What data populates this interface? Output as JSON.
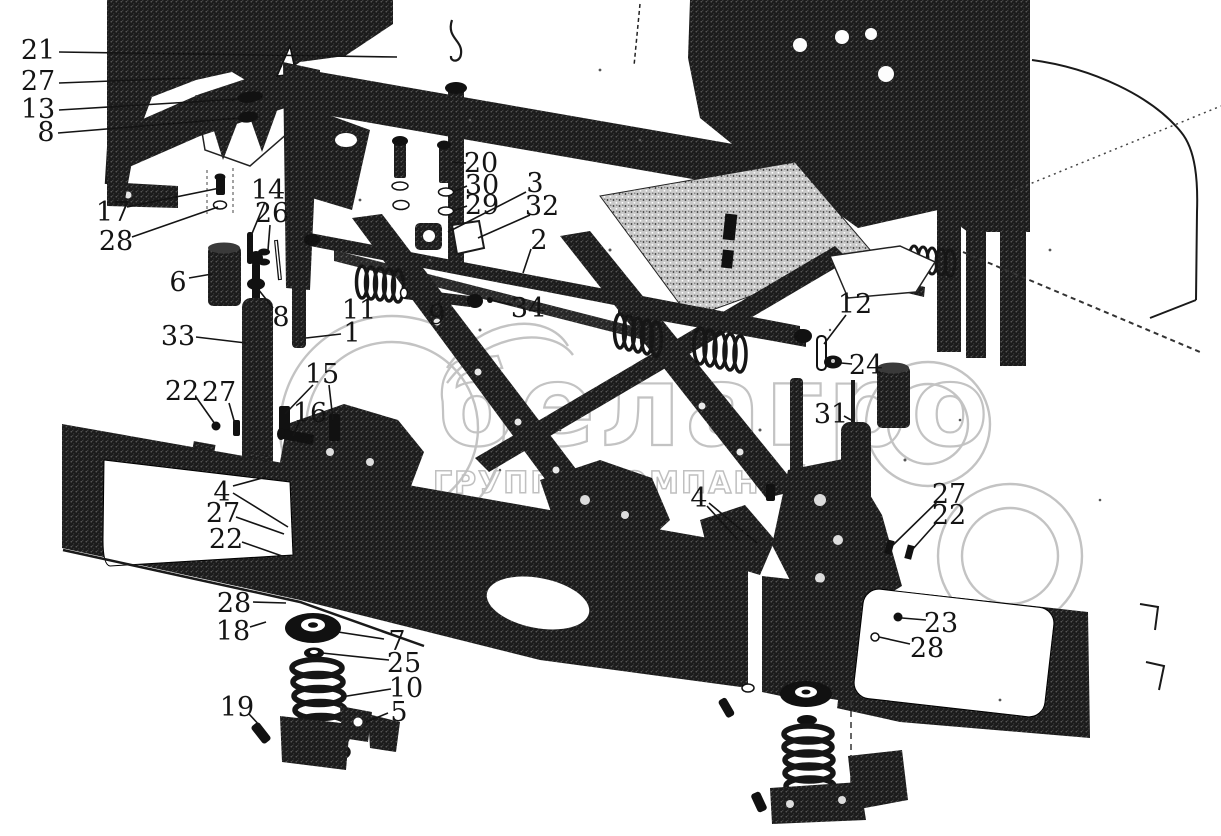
{
  "watermark": {
    "brand": "белагро",
    "subtitle": "ГРУППА КОМПАНИЙ",
    "color": "#c3c3c3"
  },
  "diagram": {
    "background": "#ffffff",
    "ink": "#141414",
    "callout_font_size": 27,
    "callouts": [
      {
        "label": "21",
        "x": 38,
        "y": 50,
        "leaders": [
          [
            59,
            52,
            397,
            57
          ]
        ]
      },
      {
        "label": "27",
        "x": 38,
        "y": 81,
        "leaders": [
          [
            59,
            83,
            190,
            78
          ]
        ]
      },
      {
        "label": "13",
        "x": 38,
        "y": 109,
        "leaders": [
          [
            59,
            110,
            240,
            99
          ]
        ]
      },
      {
        "label": "8",
        "x": 46,
        "y": 132,
        "leaders": [
          [
            58,
            133,
            240,
            118
          ]
        ]
      },
      {
        "label": "17",
        "x": 113,
        "y": 212,
        "leaders": [
          [
            127,
            207,
            220,
            188
          ]
        ]
      },
      {
        "label": "28",
        "x": 116,
        "y": 241,
        "leaders": [
          [
            132,
            237,
            218,
            207
          ]
        ]
      },
      {
        "label": "6",
        "x": 178,
        "y": 282,
        "leaders": [
          [
            189,
            278,
            212,
            274
          ]
        ]
      },
      {
        "label": "33",
        "x": 178,
        "y": 336,
        "leaders": [
          [
            196,
            337,
            246,
            343
          ]
        ]
      },
      {
        "label": "14",
        "x": 268,
        "y": 190,
        "leaders": [
          [
            265,
            202,
            251,
            236
          ]
        ]
      },
      {
        "label": "26",
        "x": 272,
        "y": 213,
        "leaders": [
          [
            270,
            225,
            268,
            250
          ]
        ]
      },
      {
        "label": "8",
        "x": 281,
        "y": 317,
        "leaders": [
          [
            273,
            308,
            258,
            289
          ]
        ]
      },
      {
        "label": "1",
        "x": 352,
        "y": 333,
        "leaders": [
          [
            341,
            334,
            306,
            338
          ]
        ]
      },
      {
        "label": "11",
        "x": 359,
        "y": 310,
        "leaders": [
          [
            362,
            299,
            368,
            293
          ]
        ]
      },
      {
        "label": "9",
        "x": 437,
        "y": 315,
        "leaders": [
          [
            439,
            304,
            441,
            298
          ]
        ]
      },
      {
        "label": "22",
        "x": 182,
        "y": 391,
        "leaders": [
          [
            196,
            397,
            215,
            424
          ]
        ]
      },
      {
        "label": "27",
        "x": 219,
        "y": 392,
        "leaders": [
          [
            229,
            403,
            235,
            424
          ]
        ]
      },
      {
        "label": "15",
        "x": 322,
        "y": 374,
        "leaders": [
          [
            313,
            385,
            285,
            414
          ],
          [
            329,
            385,
            333,
            420
          ]
        ]
      },
      {
        "label": "16",
        "x": 310,
        "y": 413,
        "leaders": [
          [
            300,
            420,
            293,
            436
          ]
        ]
      },
      {
        "label": "20",
        "x": 481,
        "y": 163,
        "leaders": [
          [
            466,
            163,
            452,
            162
          ]
        ]
      },
      {
        "label": "30",
        "x": 482,
        "y": 185,
        "leaders": [
          [
            467,
            186,
            453,
            192
          ]
        ]
      },
      {
        "label": "29",
        "x": 482,
        "y": 205,
        "leaders": [
          [
            467,
            206,
            453,
            211
          ]
        ]
      },
      {
        "label": "3",
        "x": 535,
        "y": 183,
        "leaders": [
          [
            526,
            192,
            448,
            232
          ]
        ]
      },
      {
        "label": "32",
        "x": 542,
        "y": 206,
        "leaders": [
          [
            530,
            215,
            478,
            238
          ]
        ]
      },
      {
        "label": "2",
        "x": 539,
        "y": 240,
        "leaders": [
          [
            531,
            249,
            523,
            273
          ]
        ]
      },
      {
        "label": "34",
        "x": 528,
        "y": 308,
        "leaders": [
          [
            513,
            305,
            491,
            300
          ]
        ]
      },
      {
        "label": "4",
        "x": 222,
        "y": 492,
        "leaders": [
          [
            233,
            486,
            266,
            477
          ],
          [
            233,
            493,
            288,
            527
          ]
        ]
      },
      {
        "label": "27",
        "x": 223,
        "y": 513,
        "leaders": [
          [
            236,
            517,
            284,
            534
          ]
        ]
      },
      {
        "label": "22",
        "x": 226,
        "y": 539,
        "leaders": [
          [
            242,
            542,
            282,
            556
          ]
        ]
      },
      {
        "label": "28",
        "x": 234,
        "y": 603,
        "leaders": [
          [
            253,
            602,
            286,
            603
          ]
        ]
      },
      {
        "label": "18",
        "x": 233,
        "y": 631,
        "leaders": [
          [
            250,
            627,
            266,
            622
          ]
        ]
      },
      {
        "label": "7",
        "x": 397,
        "y": 641,
        "leaders": [
          [
            384,
            639,
            338,
            632
          ]
        ]
      },
      {
        "label": "25",
        "x": 404,
        "y": 663,
        "leaders": [
          [
            389,
            660,
            322,
            653
          ]
        ]
      },
      {
        "label": "10",
        "x": 406,
        "y": 688,
        "leaders": [
          [
            391,
            689,
            341,
            697
          ]
        ]
      },
      {
        "label": "5",
        "x": 399,
        "y": 712,
        "leaders": [
          [
            388,
            713,
            366,
            722
          ]
        ]
      },
      {
        "label": "19",
        "x": 237,
        "y": 707,
        "leaders": [
          [
            249,
            714,
            262,
            728
          ]
        ]
      },
      {
        "label": "12",
        "x": 855,
        "y": 304,
        "leaders": [
          [
            846,
            315,
            824,
            344
          ]
        ]
      },
      {
        "label": "24",
        "x": 866,
        "y": 365,
        "leaders": [
          [
            852,
            364,
            841,
            363
          ]
        ]
      },
      {
        "label": "31",
        "x": 831,
        "y": 414,
        "leaders": [
          [
            844,
            416,
            851,
            420
          ]
        ]
      },
      {
        "label": "4",
        "x": 699,
        "y": 498,
        "leaders": [
          [
            707,
            506,
            738,
            540
          ],
          [
            709,
            503,
            757,
            543
          ]
        ]
      },
      {
        "label": "27",
        "x": 949,
        "y": 494,
        "leaders": [
          [
            937,
            502,
            893,
            545
          ]
        ]
      },
      {
        "label": "22",
        "x": 949,
        "y": 515,
        "leaders": [
          [
            937,
            522,
            912,
            550
          ]
        ]
      },
      {
        "label": "23",
        "x": 941,
        "y": 623,
        "leaders": [
          [
            926,
            620,
            902,
            618
          ]
        ]
      },
      {
        "label": "28",
        "x": 927,
        "y": 648,
        "leaders": [
          [
            910,
            644,
            879,
            637
          ]
        ]
      }
    ]
  }
}
